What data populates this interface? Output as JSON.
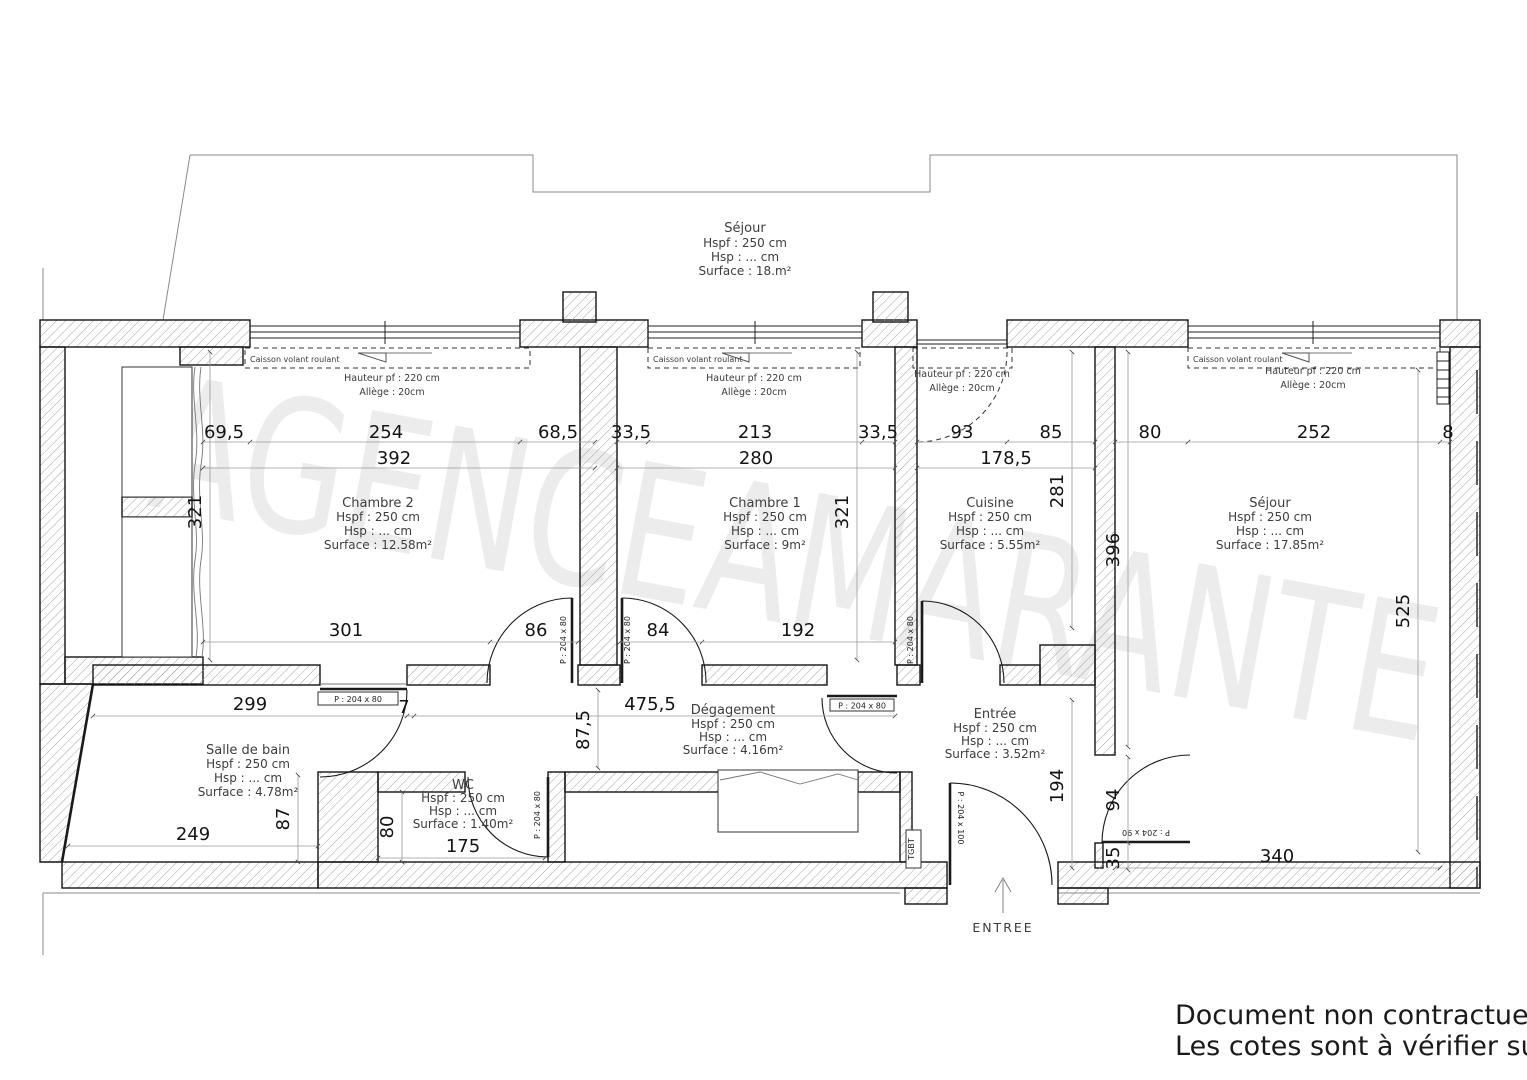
{
  "watermark": {
    "text": "AGENCEAMARANTE"
  },
  "notes": {
    "line1": "Document non contractuel",
    "line2": "Les cotes sont à vérifier sur place"
  },
  "labels": {
    "entree_arrow": "ENTREE",
    "tgbt": "TGBT"
  },
  "windows": {
    "caisson_label": "Caisson volant roulant",
    "hauteur_label": "Hauteur pf : 220 cm",
    "allege_label": "Allège : 20cm"
  },
  "doors": {
    "p80": "P : 204 x 80",
    "p90": "P : 204 x 90",
    "p100": "P : 204 x 100"
  },
  "rooms": {
    "sejour_upper": {
      "name": "Séjour",
      "hspf": "Hspf : 250 cm",
      "hsp": "Hsp : ... cm",
      "surface": "Surface : 18.m²"
    },
    "chambre2": {
      "name": "Chambre 2",
      "hspf": "Hspf : 250 cm",
      "hsp": "Hsp : ... cm",
      "surface": "Surface : 12.58m²"
    },
    "chambre1": {
      "name": "Chambre 1",
      "hspf": "Hspf : 250 cm",
      "hsp": "Hsp : ... cm",
      "surface": "Surface : 9m²"
    },
    "cuisine": {
      "name": "Cuisine",
      "hspf": "Hspf : 250 cm",
      "hsp": "Hsp : ... cm",
      "surface": "Surface : 5.55m²"
    },
    "sejour": {
      "name": "Séjour",
      "hspf": "Hspf : 250 cm",
      "hsp": "Hsp : ... cm",
      "surface": "Surface : 17.85m²"
    },
    "salle_de_bain": {
      "name": "Salle de bain",
      "hspf": "Hspf : 250 cm",
      "hsp": "Hsp : ... cm",
      "surface": "Surface : 4.78m²"
    },
    "wc": {
      "name": "WC",
      "hspf": "Hspf : 250 cm",
      "hsp": "Hsp : ... cm",
      "surface": "Surface : 1.40m²"
    },
    "degagement": {
      "name": "Dégagement",
      "hspf": "Hspf : 250 cm",
      "hsp": "Hsp : ... cm",
      "surface": "Surface : 4.16m²"
    },
    "entree": {
      "name": "Entrée",
      "hspf": "Hspf : 250 cm",
      "hsp": "Hsp : ... cm",
      "surface": "Surface : 3.52m²"
    }
  },
  "dims": {
    "ch2_left": "69,5",
    "ch2_win": "254",
    "ch2_right": "68,5",
    "ch2_total": "392",
    "ch1_left": "33,5",
    "ch1_win": "213",
    "ch1_right": "33,5",
    "ch1_total": "280",
    "cui_win": "93",
    "cui_right": "85",
    "cui_total": "178,5",
    "sej_left": "80",
    "sej_win": "252",
    "sej_right": "8",
    "ch2_h": "321",
    "ch1_h": "321",
    "cui_h": "281",
    "sej_h1": "396",
    "sej_h2": "525",
    "ch2_b": "301",
    "door_ch2": "86",
    "door_ch1": "84",
    "ch1_b": "192",
    "corr_total": "475,5",
    "sdb_top": "299",
    "gap7": "7",
    "corr_h": "87,5",
    "sdb_b": "249",
    "sdb_h": "87",
    "wc_h": "80",
    "wc_b": "175",
    "entree_h": "194",
    "sej_door": "94",
    "sej_gap": "35",
    "sej_b": "340"
  }
}
